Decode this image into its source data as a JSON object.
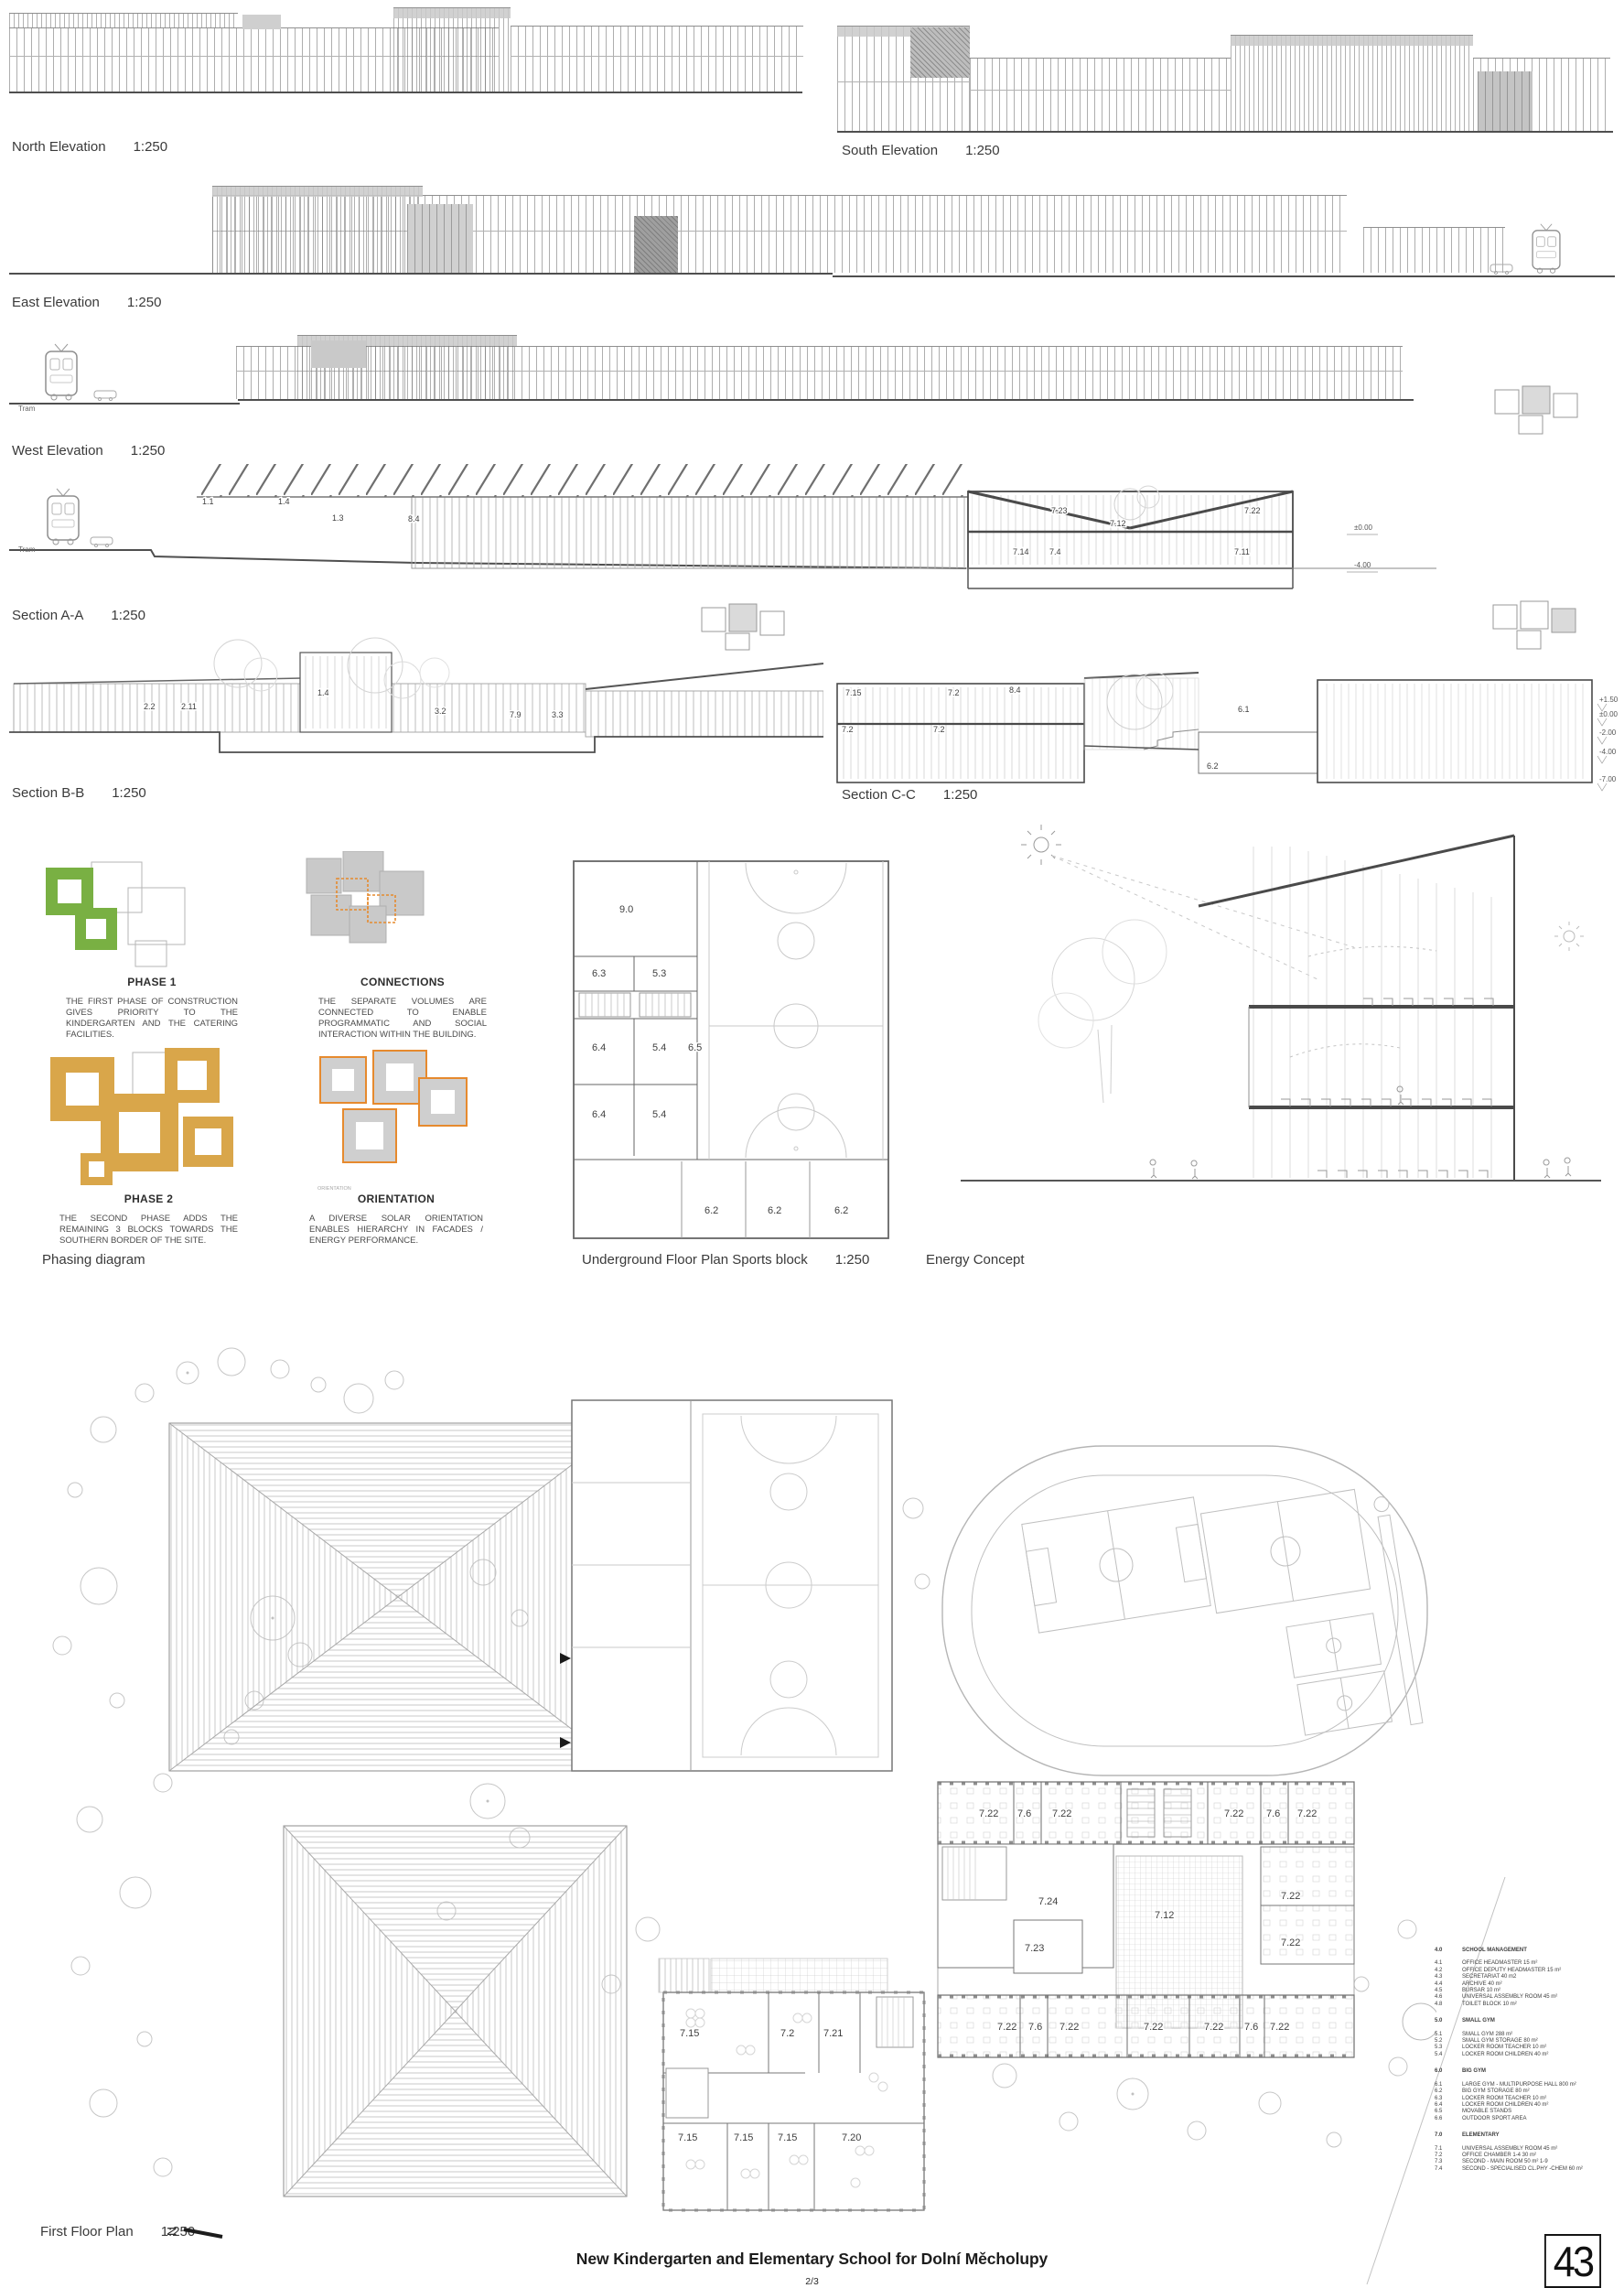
{
  "sheet": {
    "title": "New Kindergarten and Elementary School for Dolní Měcholupy",
    "page": "2/3",
    "number": "43"
  },
  "drawings": {
    "north": {
      "label": "North Elevation",
      "scale": "1:250"
    },
    "south": {
      "label": "South Elevation",
      "scale": "1:250"
    },
    "east": {
      "label": "East Elevation",
      "scale": "1:250"
    },
    "west": {
      "label": "West Elevation",
      "scale": "1:250"
    },
    "section_a": {
      "label": "Section A-A",
      "scale": "1:250"
    },
    "section_b": {
      "label": "Section B-B",
      "scale": "1:250"
    },
    "section_c": {
      "label": "Section C-C",
      "scale": "1:250"
    },
    "phasing": {
      "label": "Phasing diagram"
    },
    "underground": {
      "label": "Underground Floor Plan Sports block",
      "scale": "1:250"
    },
    "energy": {
      "label": "Energy Concept"
    },
    "first_floor": {
      "label": "First Floor Plan",
      "scale": "1:250"
    }
  },
  "tram_label": "Tram",
  "north_arrow": "N",
  "phasing": {
    "phase1": {
      "title": "PHASE 1",
      "text": "THE FIRST PHASE OF CONSTRUCTION GIVES PRIORITY TO THE KINDERGARTEN AND THE CATERING FACILITIES."
    },
    "connections": {
      "title": "CONNECTIONS",
      "text": "THE SEPARATE VOLUMES ARE CONNECTED TO ENABLE PROGRAMMATIC AND SOCIAL INTERACTION WITHIN THE BUILDING."
    },
    "phase2": {
      "title": "PHASE 2",
      "text": "THE SECOND PHASE ADDS THE REMAINING 3 BLOCKS TOWARDS THE SOUTHERN BORDER OF THE SITE."
    },
    "orientation": {
      "title": "ORIENTATION",
      "text": "A DIVERSE SOLAR ORIENTATION ENABLES HIERARCHY IN FACADES / ENERGY PERFORMANCE.",
      "mini_caption": "ORIENTATION"
    }
  },
  "section_a": {
    "rooms": [
      "1.1",
      "1.4",
      "1.3",
      "8.4",
      "7.23",
      "7.12",
      "7.22",
      "7.14",
      "7.4",
      "7.11"
    ],
    "levels": [
      "±0.00",
      "-4.00"
    ]
  },
  "section_b": {
    "rooms": [
      "2.2",
      "2.11",
      "1.4",
      "3.2",
      "7.9",
      "3.3"
    ]
  },
  "section_c": {
    "rooms": [
      "7.15",
      "7.2",
      "8.4",
      "7.2",
      "7.2",
      "6.1",
      "6.2"
    ],
    "levels": [
      "+1.50",
      "±0.00",
      "-2.00",
      "-4.00",
      "-7.00"
    ]
  },
  "underground": {
    "rooms": [
      "9.0",
      "6.3",
      "5.3",
      "6.4",
      "5.4",
      "6.5",
      "6.4",
      "5.4",
      "6.2",
      "6.2",
      "6.2"
    ]
  },
  "first_floor": {
    "top_row": [
      "7.22",
      "7.6",
      "7.22",
      "7.22",
      "7.6",
      "7.22"
    ],
    "mid": [
      "7.24",
      "7.12",
      "7.22",
      "7.23",
      "7.22"
    ],
    "bottom_row": [
      "7.22",
      "7.6",
      "7.22",
      "7.22",
      "7.22",
      "7.6",
      "7.22"
    ],
    "kindergarten": [
      "7.15",
      "7.2",
      "7.21",
      "7.15",
      "7.15",
      "7.15",
      "7.20"
    ]
  },
  "legend": {
    "sections": [
      {
        "code": "4.0",
        "title": "SCHOOL MANAGEMENT",
        "items": [
          {
            "code": "4.1",
            "label": "OFFICE HEADMASTER 15 m²"
          },
          {
            "code": "4.2",
            "label": "OFFICE DEPUTY HEADMASTER 15 m²"
          },
          {
            "code": "4.3",
            "label": "SECRETARIAT 40 m2"
          },
          {
            "code": "4.4",
            "label": "ARCHIVE 40 m²"
          },
          {
            "code": "4.5",
            "label": "BURSAR 10 m²"
          },
          {
            "code": "4.6",
            "label": "UNIVERSAL ASSEMBLY ROOM  45 m²"
          },
          {
            "code": "4.8",
            "label": "TOILET BLOCK 10 m²"
          }
        ]
      },
      {
        "code": "5.0",
        "title": "SMALL GYM",
        "items": [
          {
            "code": "5.1",
            "label": "SMALL GYM 288 m²"
          },
          {
            "code": "5.2",
            "label": "SMALL GYM STORAGE 80 m²"
          },
          {
            "code": "5.3",
            "label": "LOCKER ROOM TEACHER 10 m²"
          },
          {
            "code": "5.4",
            "label": "LOCKER ROOM CHILDREN 40 m²"
          }
        ]
      },
      {
        "code": "6.0",
        "title": "BIG GYM",
        "items": [
          {
            "code": "6.1",
            "label": "LARGE GYM - MULTIPURPOSE HALL 800 m²"
          },
          {
            "code": "6.2",
            "label": "BIG GYM STORAGE 80 m²"
          },
          {
            "code": "6.3",
            "label": "LOCKER ROOM TEACHER 10 m²"
          },
          {
            "code": "6.4",
            "label": "LOCKER ROOM CHILDREN 40 m²"
          },
          {
            "code": "6.5",
            "label": "MOVABLE STANDS"
          },
          {
            "code": "6.6",
            "label": "OUTDOOR SPORT AREA"
          }
        ]
      },
      {
        "code": "7.0",
        "title": "ELEMENTARY",
        "items": [
          {
            "code": "7.1",
            "label": "UNIVERSAL ASSEMBLY ROOM 45 m²"
          },
          {
            "code": "7.2",
            "label": "OFFICE CHAMBER 1-4 30 m²"
          },
          {
            "code": "7.3",
            "label": "SECOND - MAIN ROOM 50 m² 1-9"
          },
          {
            "code": "7.4",
            "label": "SECOND - SPECIALISED CL.PHY -CHEM 60 m²"
          }
        ]
      }
    ]
  },
  "colors": {
    "phase_green": "#79b043",
    "phase_ochre": "#d9a64a",
    "accent_orange": "#e68a2e",
    "line_gray": "#9b9b9b",
    "dark_line": "#4a4a4a"
  }
}
